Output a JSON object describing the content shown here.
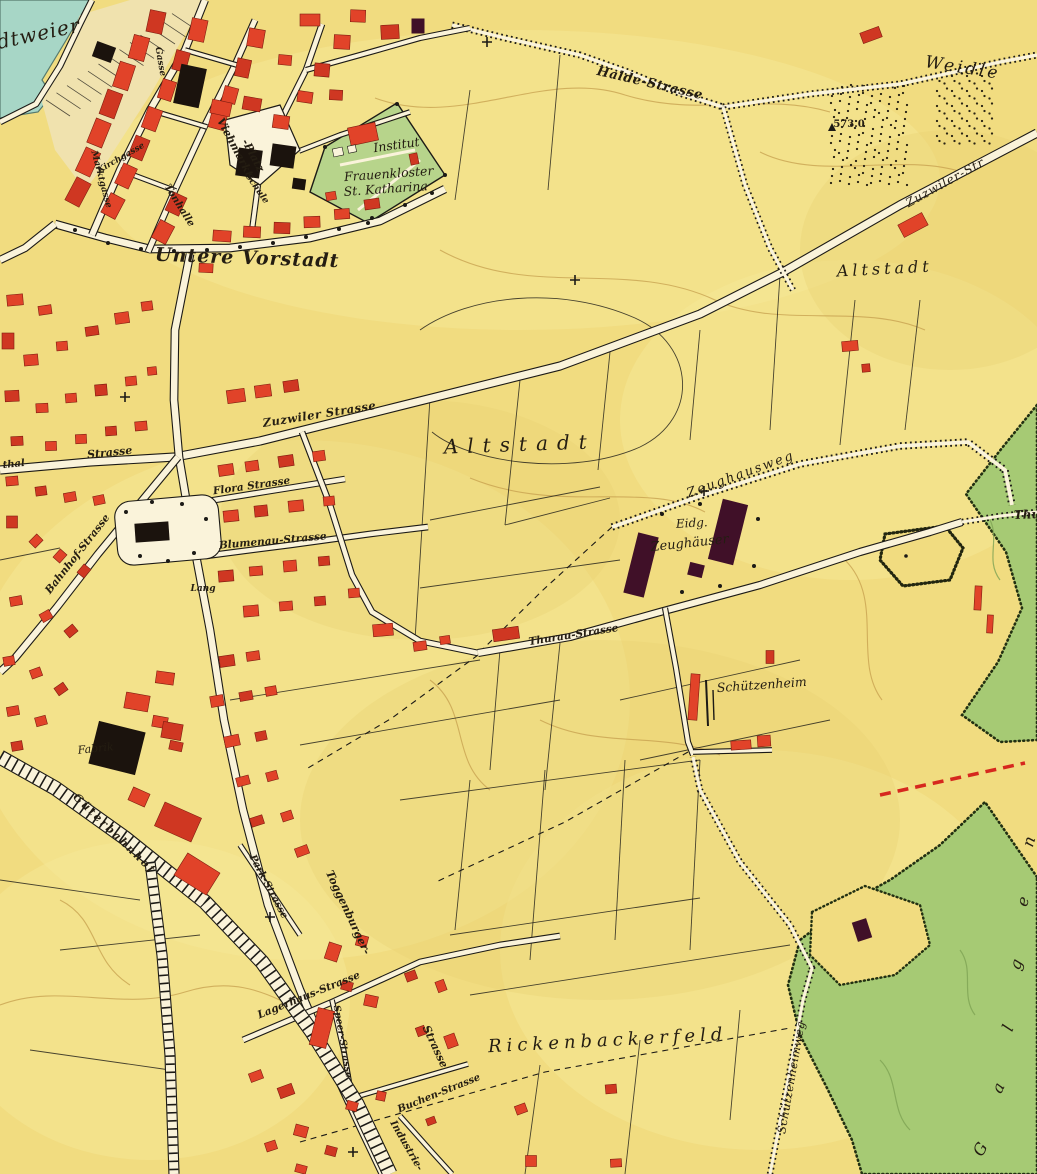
{
  "map": {
    "colors": {
      "field_yellow": "#f1dc80",
      "field_light": "#f7e898",
      "field_shade": "#e9d173",
      "pond_teal": "#a7d6c6",
      "forest_green": "#a6ca74",
      "garden_green": "#b7d48b",
      "building_red": "#e14329",
      "building_red_dark": "#cf3722",
      "building_black": "#1b130d",
      "building_maroon": "#401028",
      "road_white": "#faf3da",
      "ink": "#1c1a16",
      "contour_tan": "#c59f4e",
      "label_ink": "#241d12",
      "projected_red": "#d6281e"
    },
    "spot_heights": [
      "573.0"
    ],
    "labels": [
      {
        "id": "stadtweier",
        "text": "Stadtweier"
      },
      {
        "id": "untere-vorstadt",
        "text": "Untere Vorstadt"
      },
      {
        "id": "institut",
        "text": "Institut"
      },
      {
        "id": "frauenkloster",
        "text": "Frauenkloster"
      },
      {
        "id": "st-katharina",
        "text": "St. Katharina"
      },
      {
        "id": "viehmarkt",
        "text": "Viehmarkt-"
      },
      {
        "id": "viehmarkt-platz",
        "text": "-Platz"
      },
      {
        "id": "tonhalle",
        "text": "Tonhalle"
      },
      {
        "id": "marktgasse",
        "text": "Marktgasse"
      },
      {
        "id": "kirchgasse",
        "text": "Kirchgasse"
      },
      {
        "id": "gasse",
        "text": "Gasse"
      },
      {
        "id": "schule",
        "text": "Schule"
      },
      {
        "id": "halde-strasse",
        "text": "Halde-Strasse"
      },
      {
        "id": "weidle",
        "text": "Weidle"
      },
      {
        "id": "spot-height-573",
        "text": "573.0"
      },
      {
        "id": "zuzwiler-str-ne",
        "text": "Zuzwiler-Str"
      },
      {
        "id": "altstadt-east",
        "text": "Altstadt"
      },
      {
        "id": "altstadt-center",
        "text": "Altstadt"
      },
      {
        "id": "zuzwiler-strasse",
        "text": "Zuzwiler Strasse"
      },
      {
        "id": "thal-fragment",
        "text": "thal"
      },
      {
        "id": "strasse-west",
        "text": "Strasse"
      },
      {
        "id": "flora-strasse",
        "text": "Flora Strasse"
      },
      {
        "id": "blumenau-strasse",
        "text": "Blumenau-Strasse"
      },
      {
        "id": "bahnhof-strasse",
        "text": "Bahnhof-Strasse"
      },
      {
        "id": "lang",
        "text": "Lang"
      },
      {
        "id": "gueterbahnhof",
        "text": "Güterbahnhof"
      },
      {
        "id": "park-strasse",
        "text": "Park-Strasse"
      },
      {
        "id": "toggenburger",
        "text": "Toggenburger-"
      },
      {
        "id": "toggenburger-strasse",
        "text": "Strasse"
      },
      {
        "id": "lagerhaus-strasse",
        "text": "Lagerhaus-Strasse"
      },
      {
        "id": "speer-strasse",
        "text": "Speer-Strasse"
      },
      {
        "id": "buchen-strasse",
        "text": "Buchen-Strasse"
      },
      {
        "id": "industrie-strasse",
        "text": "Industrie-"
      },
      {
        "id": "zeughausweg",
        "text": "Zeughausweg"
      },
      {
        "id": "eidg",
        "text": "Eidg."
      },
      {
        "id": "zeughaeuser",
        "text": "Zeughäuser"
      },
      {
        "id": "thurau-strasse",
        "text": "Thurau-Strasse"
      },
      {
        "id": "schuetzenheim",
        "text": "Schützenheim"
      },
      {
        "id": "rickenbackerfeld",
        "text": "Rickenbackerfeld"
      },
      {
        "id": "schuetzenheimweg",
        "text": "Schützenheimweg"
      },
      {
        "id": "galgen-g",
        "text": "G"
      },
      {
        "id": "galgen-a",
        "text": "a"
      },
      {
        "id": "galgen-l",
        "text": "l"
      },
      {
        "id": "galgen-g2",
        "text": "g"
      },
      {
        "id": "galgen-e",
        "text": "e"
      },
      {
        "id": "galgen-n",
        "text": "n"
      },
      {
        "id": "thurau-forest",
        "text": "Thurau"
      },
      {
        "id": "fabrik",
        "text": "Fabrik"
      }
    ]
  }
}
